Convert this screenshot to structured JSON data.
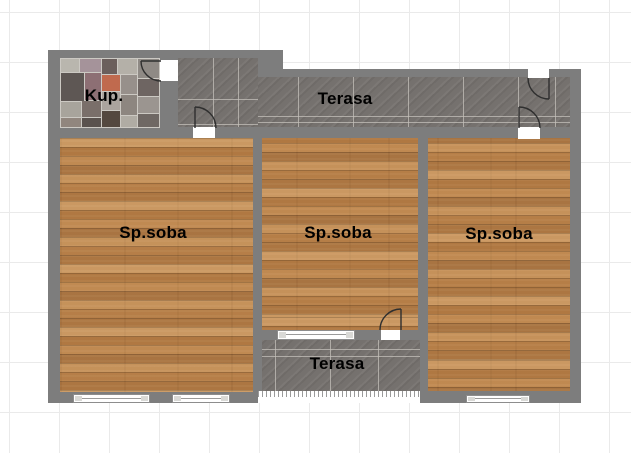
{
  "plan": {
    "title": "apartment-floor-plan",
    "rooms": [
      {
        "id": "kup",
        "label": "Kup.",
        "type": "bathroom"
      },
      {
        "id": "terasa-top",
        "label": "Terasa",
        "type": "terrace"
      },
      {
        "id": "sp-soba-left",
        "label": "Sp.soba",
        "type": "bedroom"
      },
      {
        "id": "sp-soba-mid",
        "label": "Sp.soba",
        "type": "bedroom"
      },
      {
        "id": "sp-soba-right",
        "label": "Sp.soba",
        "type": "bedroom"
      },
      {
        "id": "terasa-bottom",
        "label": "Terasa",
        "type": "terrace"
      }
    ],
    "symbols": {
      "doors": 5,
      "windows": 4
    },
    "colors": {
      "background": "#ffffff",
      "grid_line": "#eaeaea",
      "wall": "#7d7d7d",
      "terrace_tile": "#75716e",
      "wood_floor": "#b98551",
      "label_text": "#000000",
      "door_stroke": "#2f2f2f"
    }
  }
}
